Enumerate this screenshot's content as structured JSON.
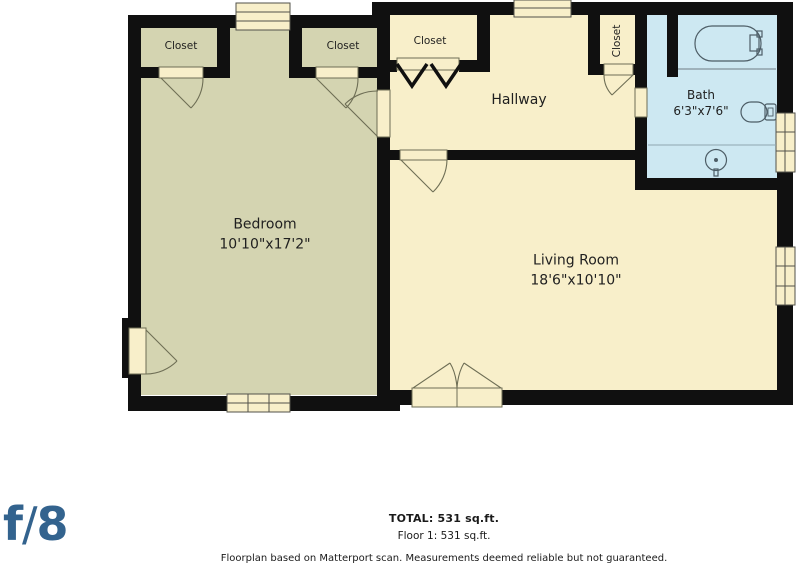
{
  "rooms": {
    "bedroom": {
      "name": "Bedroom",
      "dims": "10'10\"x17'2\""
    },
    "living_room": {
      "name": "Living Room",
      "dims": "18'6\"x10'10\""
    },
    "hallway": {
      "name": "Hallway"
    },
    "bath": {
      "name": "Bath",
      "dims": "6'3\"x7'6\""
    },
    "closets": {
      "bedroom_left": "Closet",
      "bedroom_right": "Closet",
      "hallway": "Closet",
      "hallway_vertical": "Closet"
    }
  },
  "footer": {
    "total": "TOTAL: 531 sq.ft.",
    "floor": "Floor 1: 531 sq.ft.",
    "disclaimer": "Floorplan based on Matterport scan. Measurements deemed reliable but not guaranteed."
  },
  "logo": {
    "f": "f",
    "slash": "/",
    "eight": "8"
  },
  "colors": {
    "wall": "#101010",
    "bedroom_fill": "#d4d4b1",
    "room_fill": "#f8efca",
    "bath_fill": "#cde8f2",
    "door_line": "#6e6e55",
    "fixture_line": "#4d5d66",
    "text": "#1f1f1f",
    "logo_blue": "#33638e"
  }
}
